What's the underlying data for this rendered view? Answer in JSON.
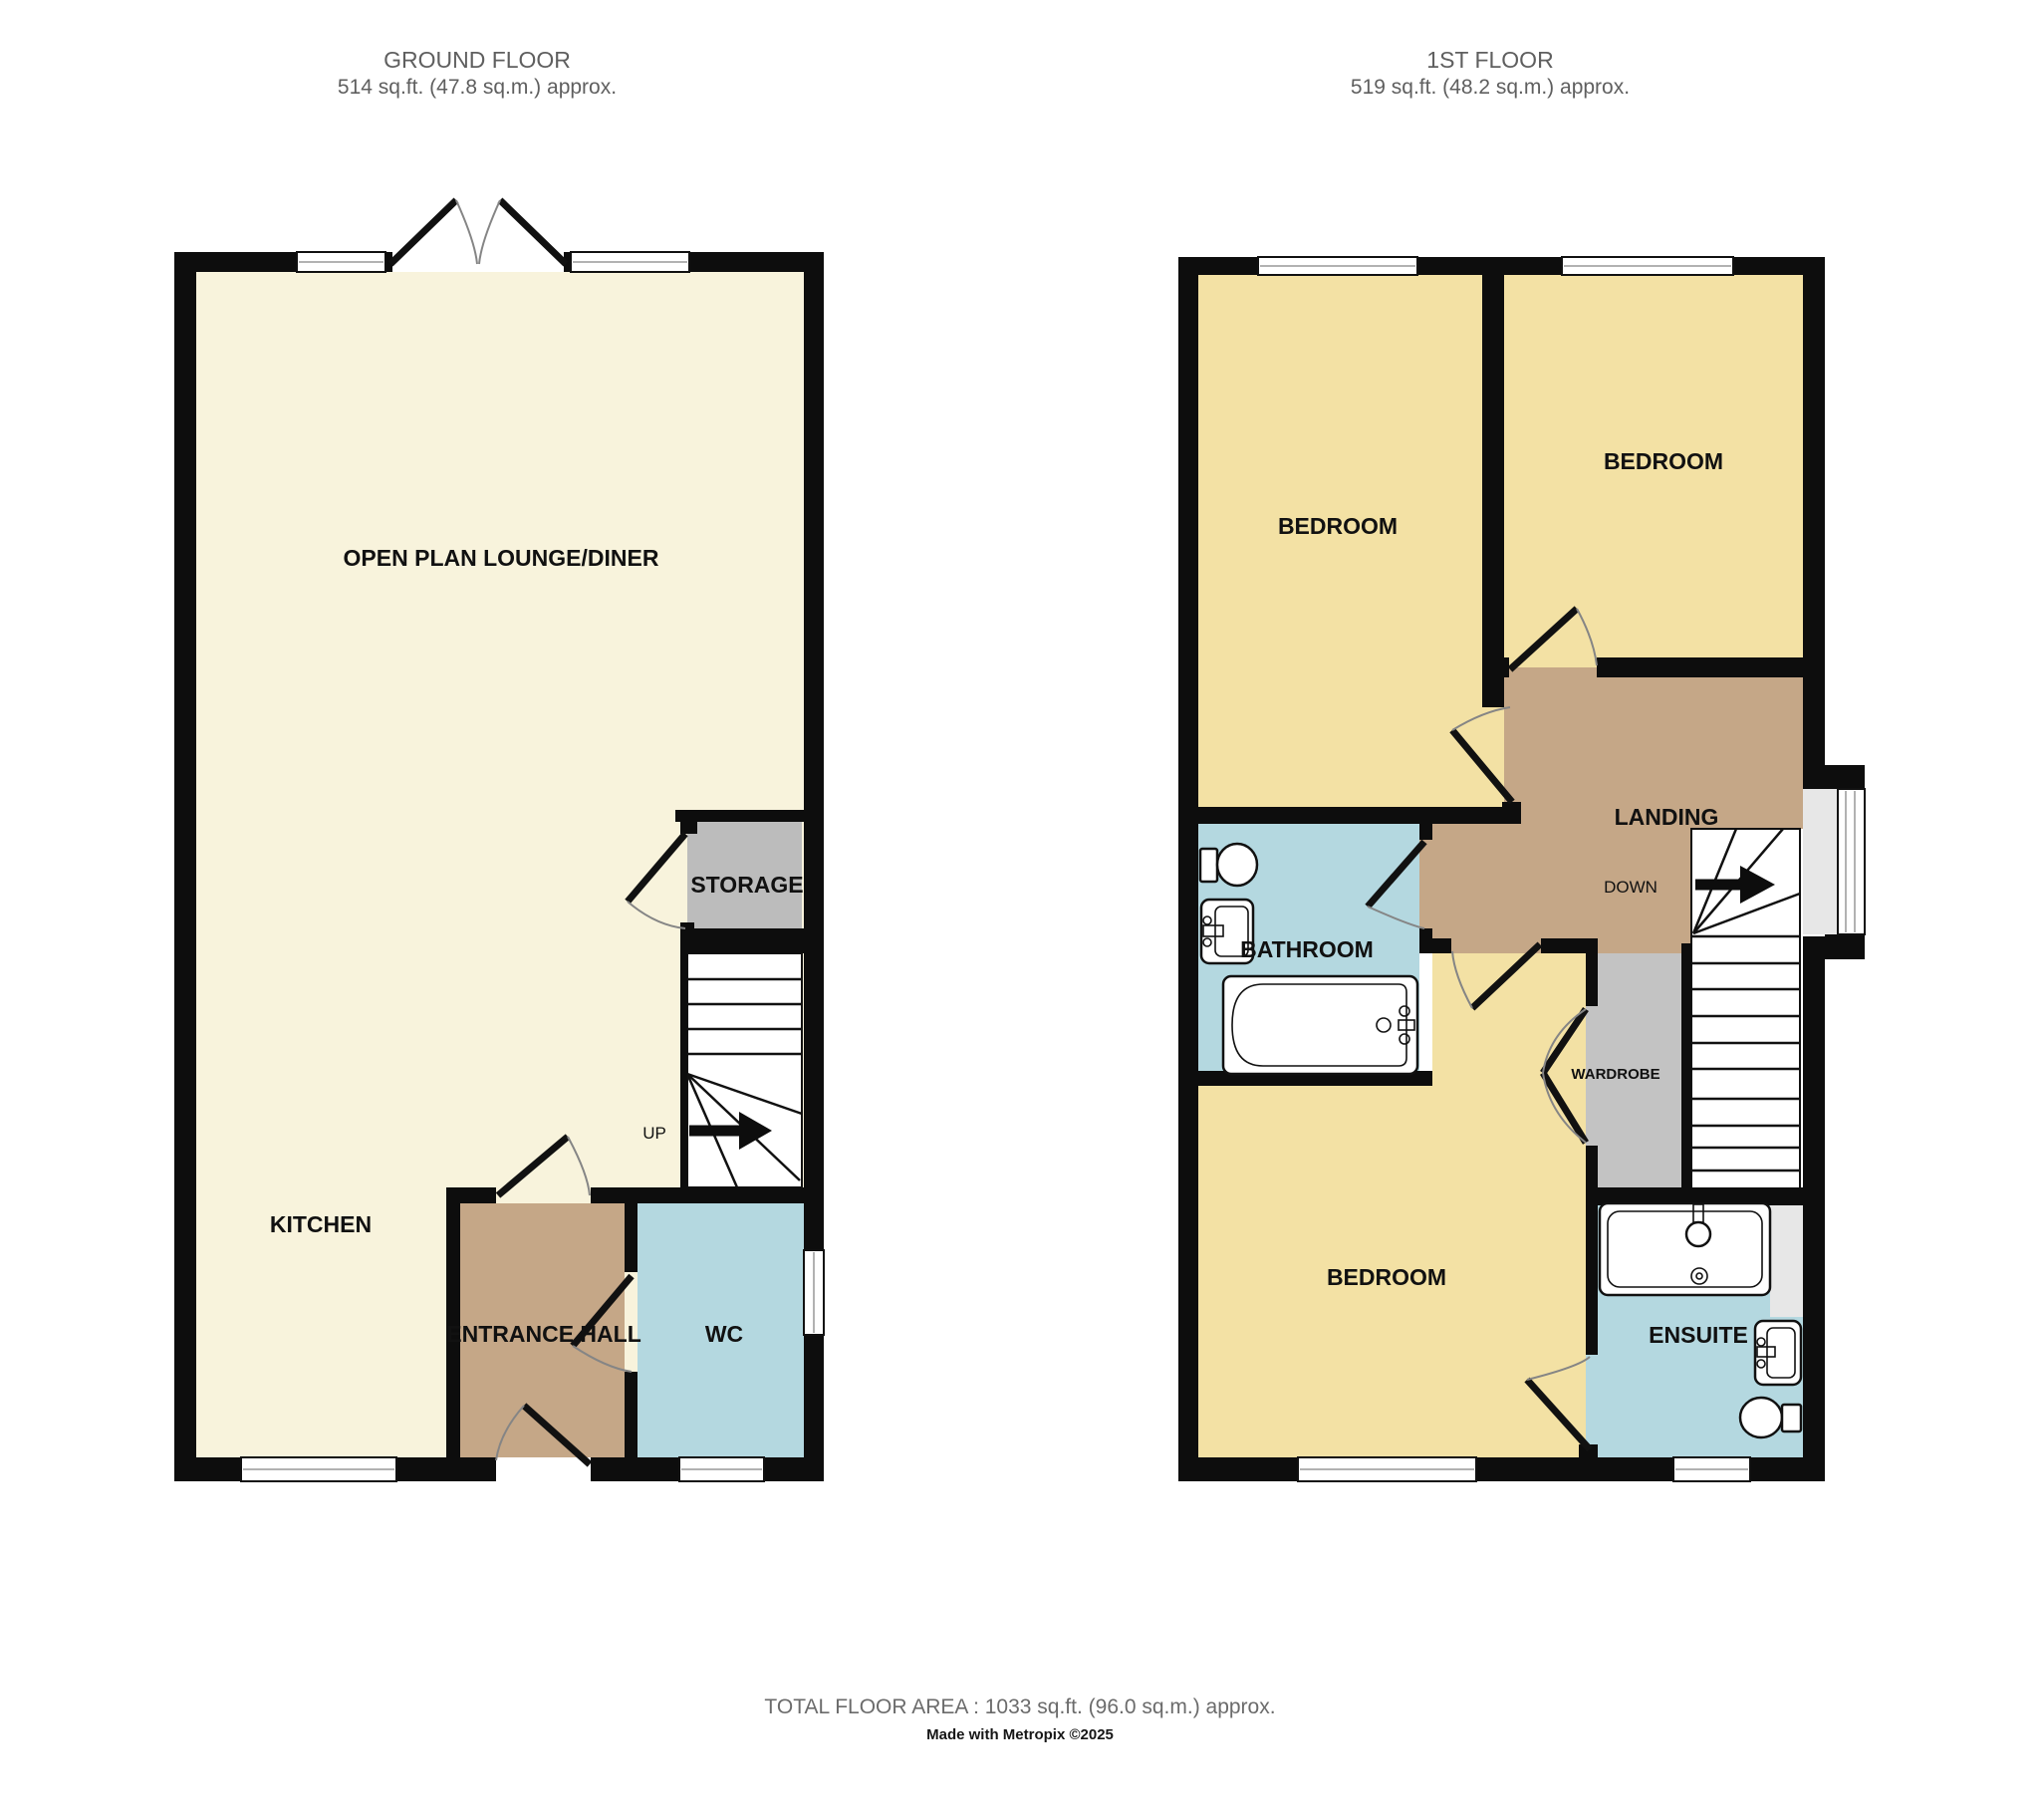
{
  "ground_floor": {
    "title": "GROUND FLOOR",
    "area": "514 sq.ft. (47.8 sq.m.) approx.",
    "rooms": {
      "lounge": "OPEN PLAN LOUNGE/DINER",
      "kitchen": "KITCHEN",
      "storage": "STORAGE",
      "entrance_hall": "ENTRANCE HALL",
      "wc": "WC",
      "stairs_direction": "UP"
    }
  },
  "first_floor": {
    "title": "1ST FLOOR",
    "area": "519 sq.ft. (48.2 sq.m.) approx.",
    "rooms": {
      "bedroom_left": "BEDROOM",
      "bedroom_right": "BEDROOM",
      "bedroom_bottom": "BEDROOM",
      "bathroom": "BATHROOM",
      "landing": "LANDING",
      "wardrobe": "WARDROBE",
      "ensuite": "ENSUITE",
      "stairs_direction": "DOWN"
    }
  },
  "footer": {
    "total_area": "TOTAL FLOOR AREA : 1033 sq.ft. (96.0 sq.m.) approx.",
    "credit": "Made with Metropix ©2025"
  },
  "colors": {
    "wall": "#0d0d0d",
    "lounge_kitchen": "#f8f3dc",
    "bedroom": "#f3e1a4",
    "hall_landing": "#c5a787",
    "wet_room": "#b4d8e0",
    "storage": "#bcbcbc",
    "bay_sill": "#e7e7e7",
    "header_text": "#5f5f5f",
    "footer_text": "#6b6b6b"
  }
}
